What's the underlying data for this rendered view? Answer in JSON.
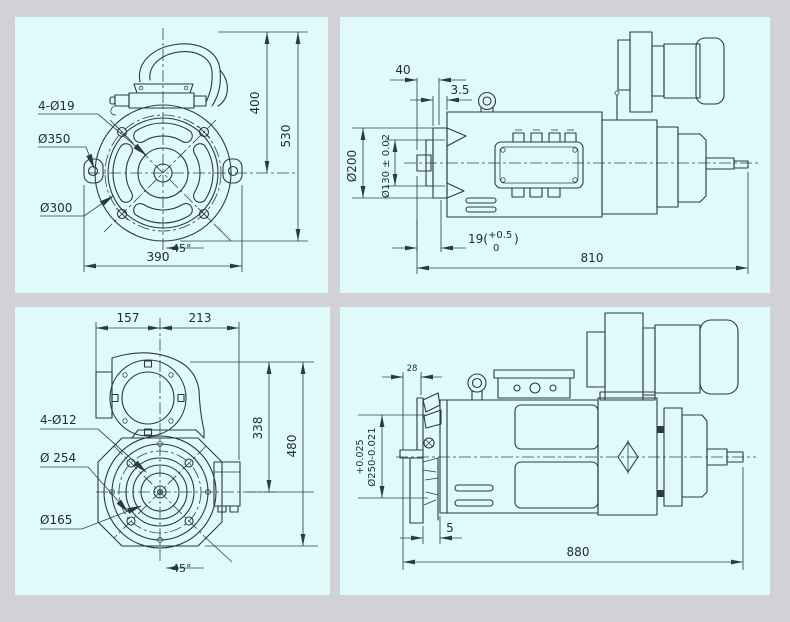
{
  "theme": {
    "canvas_bg": "#d2d2d6",
    "panel_bg": "#e0f9fa",
    "line_ink": "#2b3b42",
    "text_ink": "#1f2b31"
  },
  "panels": {
    "tl": {
      "description": "front view of flange-mounted motor with lifting handle",
      "bolt_holes": "4-Ø19",
      "flange_od": "Ø350",
      "bolt_circle": "Ø300",
      "center_height": "400",
      "total_height": "530",
      "base_width": "390",
      "angle": "45°"
    },
    "tr": {
      "description": "side view of motor with brake unit, total length 810",
      "flange_offset": "40",
      "flange_thickness": "3.5",
      "flange_dia": "Ø200",
      "spigot_dia": "Ø130 ± 0.02",
      "key_prefix": "19(",
      "key_upper": "+0.5",
      "key_lower": "0",
      "key_close": ")",
      "total_length": "810"
    },
    "bl": {
      "description": "front view of blower-cooled motor",
      "width_left": "157",
      "width_right": "213",
      "bolt_holes": "4-Ø12",
      "bolt_circle": "Ø 254",
      "spigot_dia": "Ø165",
      "center_height": "338",
      "total_height": "480",
      "angle": "45°"
    },
    "br": {
      "description": "side view of blower-cooled motor, total length 880",
      "offset": "28",
      "tol_upper": "+0.025",
      "dia_with_tol": "Ø250-0.021",
      "gap": "5",
      "total_length": "880"
    }
  }
}
